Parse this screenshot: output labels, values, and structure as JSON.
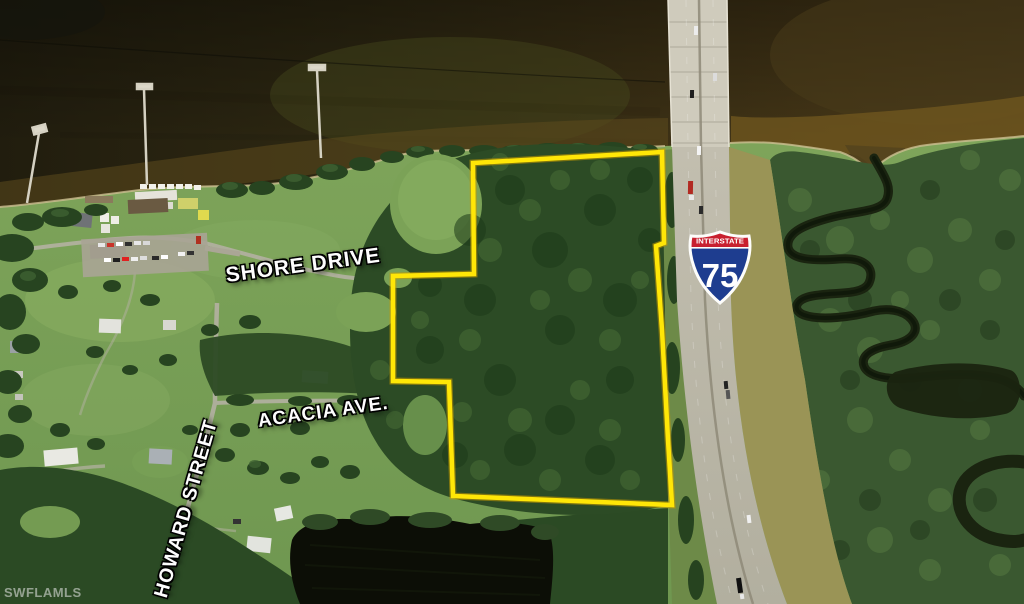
{
  "map": {
    "description": "Aerial satellite listing photo of a wooded vacant parcel outlined in yellow, between a residential shoreline neighborhood and Interstate 75, with a river across the top and a winding creek through swamp on the right.",
    "watermark": "SWFLAMLS",
    "streets": [
      {
        "id": "shore-drive",
        "name": "SHORE DRIVE"
      },
      {
        "id": "acacia-ave",
        "name": "ACACIA AVE."
      },
      {
        "id": "howard-street",
        "name": "HOWARD STREET"
      }
    ],
    "highway_shield": {
      "banner": "INTERSTATE",
      "number": "75",
      "banner_color": "#c8202f",
      "shield_color": "#1e3d8f"
    },
    "property_boundary": {
      "color": "#ffe607",
      "points": "473,163 662,152 664,243 656,246 662,330 668,440 672,505 453,496 449,382 393,381 393,276 474,274"
    },
    "colors": {
      "river_water": "#3b3015",
      "forest_green": "#2c4b25",
      "field_green": "#7ba35a",
      "swamp_green": "#3a5830",
      "highway_concrete": "#c6c2b3",
      "pond_dark": "#0c0e06"
    }
  }
}
